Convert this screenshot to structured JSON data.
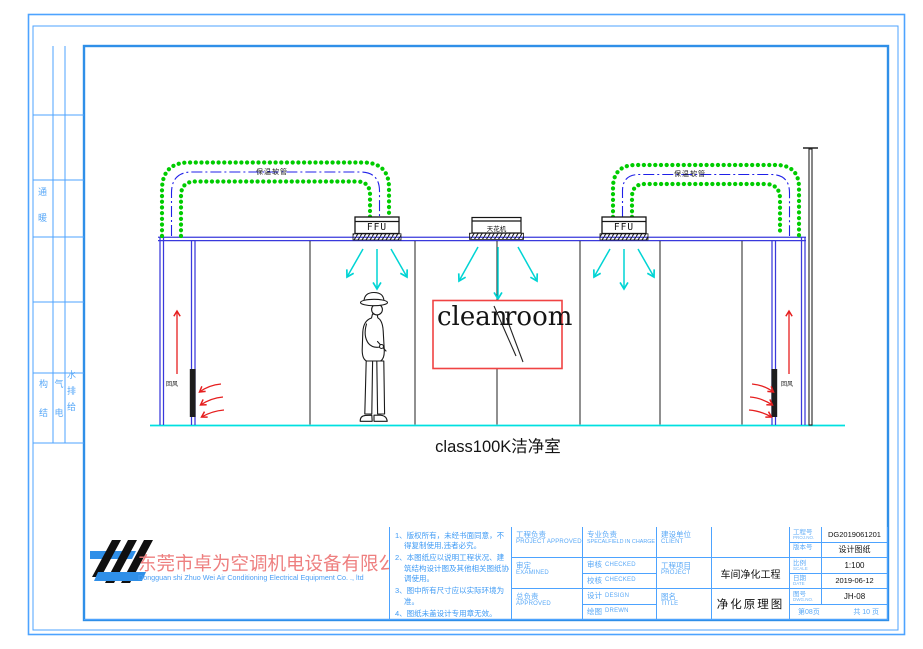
{
  "colors": {
    "frame_blue": "#4da3ff",
    "thick_frame_blue": "#2f8fe8",
    "wall_blue": "#3939dc",
    "duct_centerline_blue": "#2020e8",
    "insulation_green": "#00cc00",
    "floor_cyan": "#00e0e0",
    "supply_air_cyan": "#00d4d4",
    "return_air_red": "#e61e1e",
    "clean_room_box_red": "#f04343",
    "company_name_pink": "#ee7f7f",
    "label_text_blue": "#5aa9f7",
    "drawing_black": "#141414"
  },
  "left_strip": {
    "disciplines": [
      {
        "name": "暖通",
        "stack": "通暖"
      },
      {
        "name": "结构",
        "stack": "构结"
      },
      {
        "name": "电气",
        "stack": "气电"
      },
      {
        "name": "给排水",
        "stack": "水排给"
      }
    ]
  },
  "drawing": {
    "duct_label": "保温软管",
    "ffu_label": "FFU",
    "ceiling_unit_label": "天花机",
    "return_air_label": "回风",
    "clean_room_word1": "clean",
    "clean_room_word2": "room",
    "caption": "class100K洁净室"
  },
  "title_block": {
    "company": {
      "name_cn": "东莞市卓为空调机电设备有限公司",
      "name_en": "Dongguan shi Zhuo Wei Air Conditioning Electrical Equipment Co. ., ltd"
    },
    "notes": [
      "1、版权所有，未经书面同意，不得复制使用,违者必究。",
      "2、本图纸应以说明工程状况、建筑结构设计图及其他相关图纸协调使用。",
      "3、图中所有尺寸应以实际环境为准。",
      "4、图纸未盖设计专用章无效。"
    ],
    "signoff": {
      "project_approved_cn": "工程负责",
      "project_approved_en": "PROJECT APPROVED",
      "examined_cn": "审定",
      "examined_en": "EXAMINED",
      "approved_cn": "总负责",
      "approved_en": "APPROVED",
      "special_field_cn": "专业负责",
      "special_field_en": "SPECALFIELD IN CHARGE",
      "checked1_cn": "审核",
      "checked1_en": "CHECKED",
      "checked2_cn": "校核",
      "checked2_en": "CHECKED",
      "design_cn": "设计",
      "design_en": "DESIGN",
      "drawn_cn": "绘图",
      "drawn_en": "DREWN"
    },
    "project": {
      "client_cn": "建设单位",
      "client_en": "CLIENT",
      "client_value": "",
      "project_cn": "工程项目",
      "project_en": "PROJECT",
      "project_value": "车间净化工程",
      "title_cn": "图名",
      "title_en": "TITLE",
      "title_value": "净化原理图"
    },
    "info": {
      "rows": [
        {
          "label": "工程号",
          "sub": "PROJ.NO.",
          "value": "DG2019061201"
        },
        {
          "label": "版本号",
          "sub": "",
          "value": "设计图纸"
        },
        {
          "label": "比例",
          "sub": "SCALE",
          "value": "1:100"
        },
        {
          "label": "日期",
          "sub": "DATE",
          "value": "2019-06-12"
        },
        {
          "label": "图号",
          "sub": "DWG.NO.",
          "value": "JH-08"
        }
      ],
      "page_left": "第08页",
      "page_right": "共 10 页"
    }
  }
}
